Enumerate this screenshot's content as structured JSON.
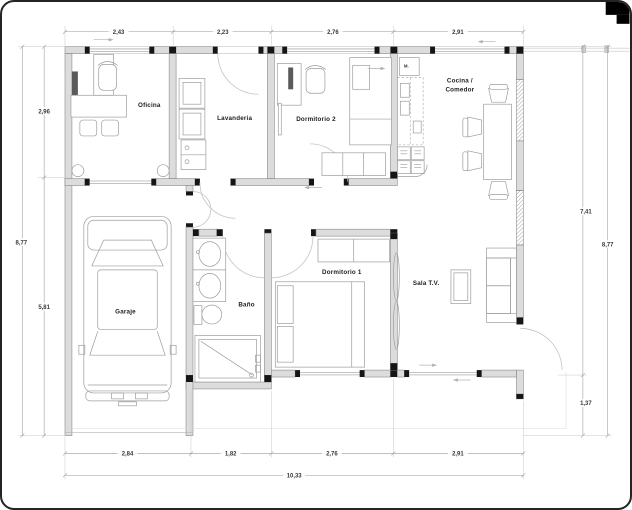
{
  "plan": {
    "title_hint": "house floor plan",
    "rooms": {
      "oficina": "Oficina",
      "lavanderia": "Lavanderia",
      "dormitorio2": "Dormitorio 2",
      "cocina_line1": "Cocina /",
      "cocina_line2": "Comedor",
      "garaje": "Garaje",
      "bano": "Baño",
      "dormitorio1": "Dormitorio 1",
      "sala": "Sala T.V."
    },
    "kitchen_appliance_label": "M.",
    "dimensions": {
      "top": [
        "2,43",
        "2,23",
        "2,76",
        "2,91"
      ],
      "bottom": [
        "2,84",
        "1,82",
        "2,76",
        "2,91"
      ],
      "bottom_total": "10,33",
      "left": [
        "2,96",
        "5,81"
      ],
      "left_total": "8,77",
      "right": [
        "7,41",
        "1,37"
      ],
      "right_total": "8,77"
    },
    "colors": {
      "wall_fill": "#dcdcdc",
      "wall_edge": "#8a8a8a",
      "jamb": "#151515",
      "line_work": "#9c9c9c",
      "dimension_text": "#3a3a3a",
      "paper": "#ffffff",
      "border": "#242424"
    }
  }
}
